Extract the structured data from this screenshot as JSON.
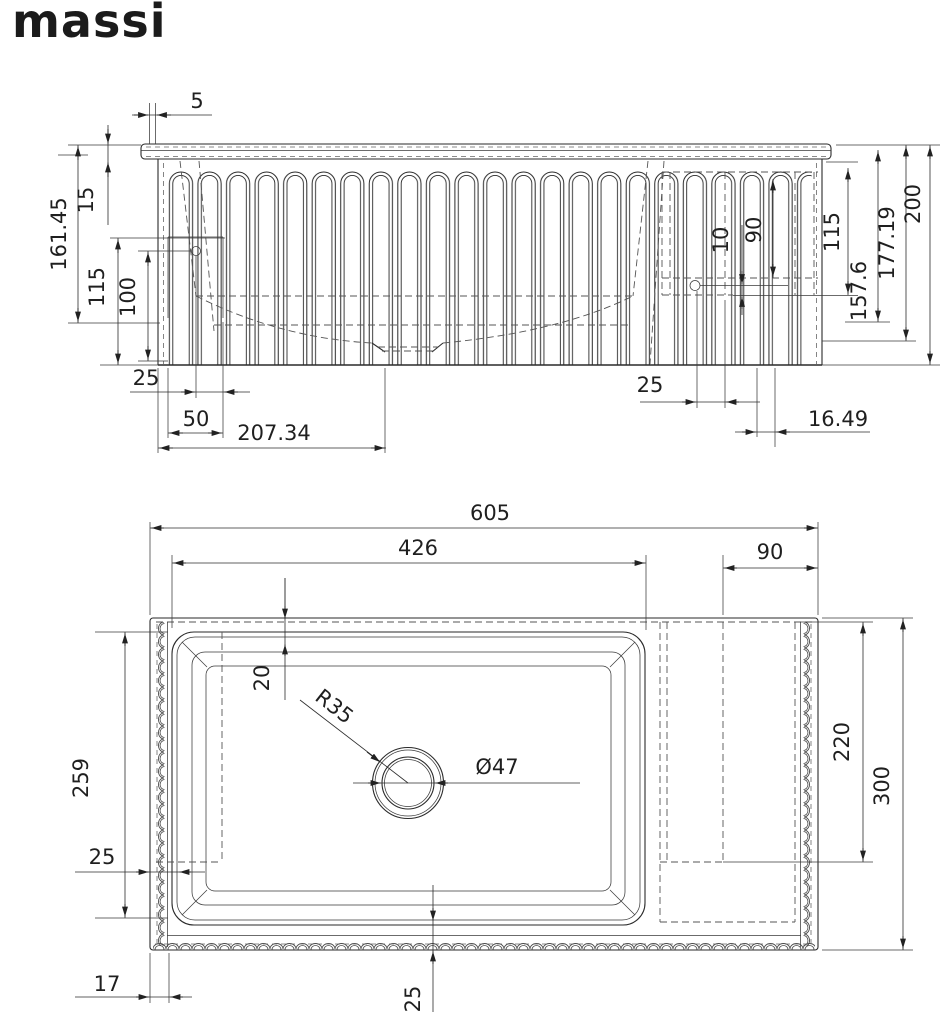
{
  "brand": {
    "logo": "massi"
  },
  "colors": {
    "ink": "#222222",
    "hidden_line": "#555555",
    "background": "#ffffff"
  },
  "views": {
    "front": {
      "dimensions": {
        "rim_overhang": "5",
        "height_total_left": "161.45",
        "rim_height": "15",
        "left_inner_depth": "115",
        "left_bowl_depth": "100",
        "bottom_left_wall": "25",
        "bottom_left_ledge": "50",
        "bottom_left_to_drain": "207.34",
        "right_ledge_gap": "10",
        "right_ledge_height": "90",
        "right_inner_depth": "115",
        "right_height_a": "157.6",
        "right_height_b": "177.19",
        "height_total": "200",
        "bottom_right_wall": "25",
        "bottom_right_inset": "16.49"
      }
    },
    "plan": {
      "dimensions": {
        "width_total": "605",
        "bowl_width": "426",
        "drainboard_width": "90",
        "rim_to_bowl": "20",
        "corner_radius": "R35",
        "drain_diameter": "Ø47",
        "bowl_length": "259",
        "left_wall": "25",
        "flute_depth": "17",
        "bottom_wall": "25",
        "drainboard_length": "220",
        "depth_total": "300"
      }
    }
  }
}
